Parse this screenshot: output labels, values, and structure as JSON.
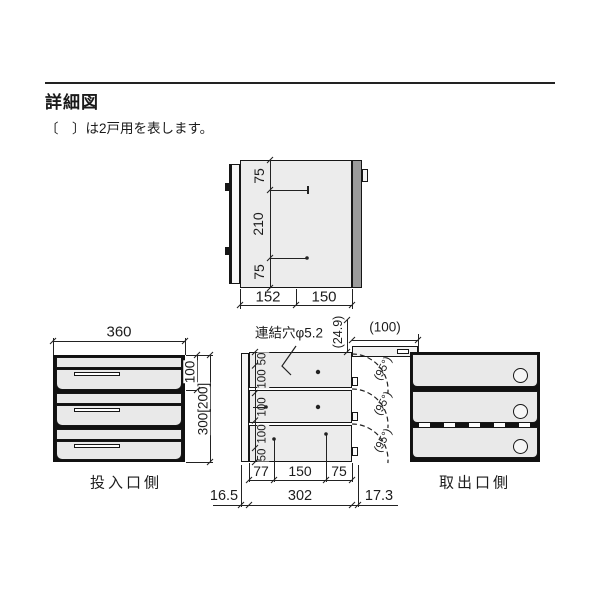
{
  "page": {
    "title": "詳細図",
    "note": "〔　〕は2戸用を表します。"
  },
  "plan_view": {
    "dim_side_top": "75",
    "dim_side_mid": "210",
    "dim_side_bottom": "75",
    "dim_depth_front": "152",
    "dim_depth_rear": "150"
  },
  "front_view": {
    "dim_width": "360",
    "dim_unit_height": "100",
    "dim_total_height": "300[200]",
    "label": "投入口側"
  },
  "section_view": {
    "hole_note": "連結穴φ5.2",
    "dim_door_offset": "(24.9)",
    "dim_door_open": "(100)",
    "dims_left": [
      "50",
      "100",
      "100",
      "100",
      "50"
    ],
    "angle_labels": [
      "(95°)",
      "(95°)",
      "(95°)"
    ],
    "dims_bottom_row1": [
      "77",
      "150",
      "75"
    ],
    "dims_bottom_row2": [
      "16.5",
      "302",
      "17.3"
    ]
  },
  "rear_view": {
    "label": "取出口側"
  },
  "colors": {
    "line": "#1a1a1a",
    "body_fill": "#ececec",
    "rear_door_fill": "#9b9b9b"
  }
}
